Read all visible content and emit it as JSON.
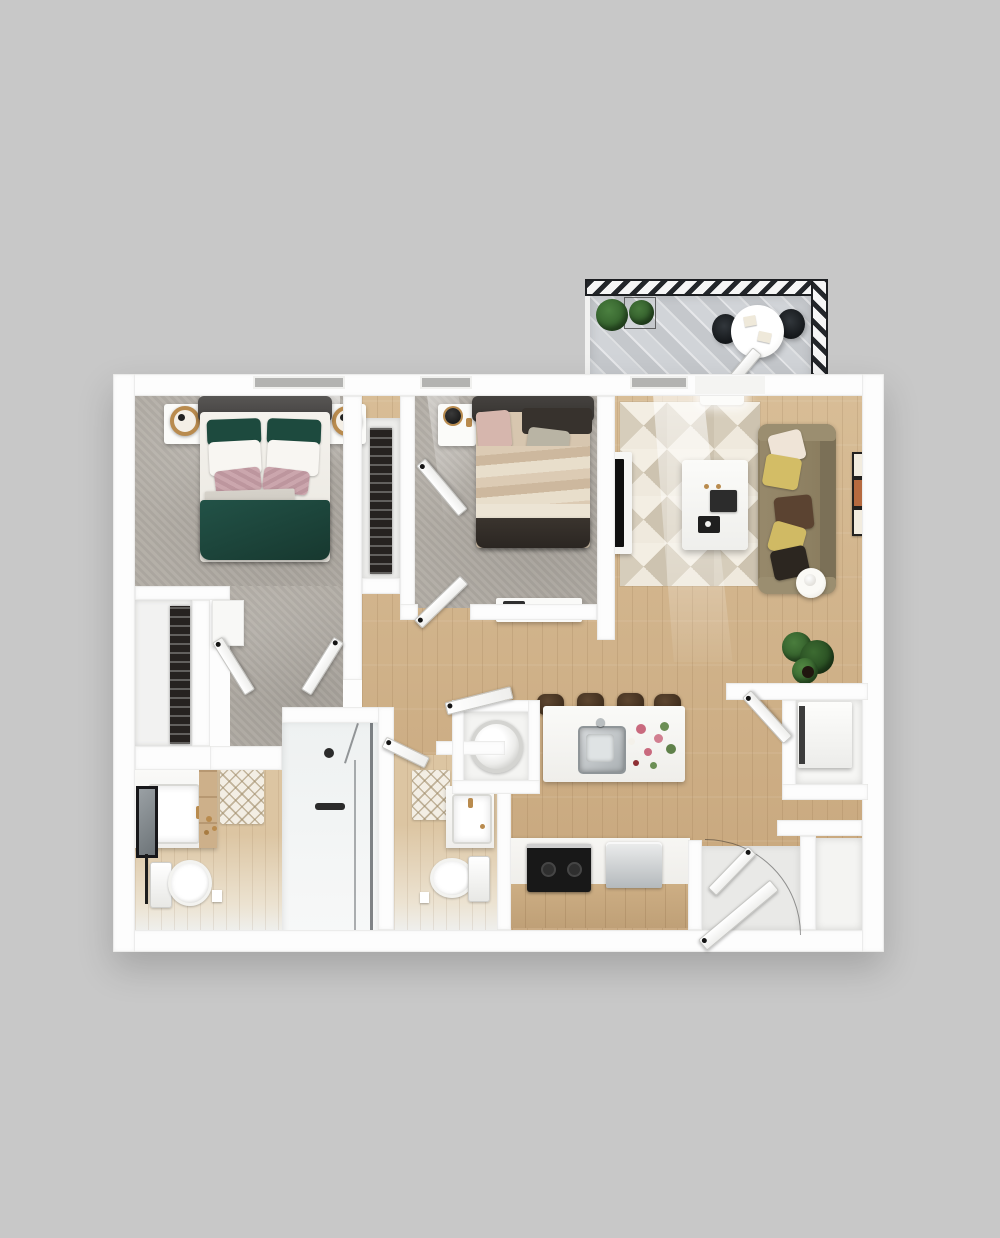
{
  "meta": {
    "scene": "3D top-down rendering of a two-bedroom, two-bath apartment floor plan with balcony",
    "view": "top-down",
    "background_color": "#c8c8c8",
    "visible_text": "none"
  },
  "palette": {
    "background": "#c8c8c8",
    "wall": "#fdfdfd",
    "wall_edge": "#e6e6e4",
    "carpet_gray": "#b2ada5",
    "wood_floor_tan": "#cfae85",
    "bath_floor_light": "#dcc5a2",
    "balcony_floor_gray": "#cdd0d4",
    "railing_black": "#23262a",
    "duvet_green": "#1d473c",
    "pillow_pink": "#c6a1a8",
    "headboard_gray": "#4c4a48",
    "bed2_tan": "#d2bfa5",
    "bed2_footer_brown": "#332d28",
    "sofa_olive": "#8d8063",
    "pillow_yellow": "#d3bd66",
    "pillow_brown": "#5b4331",
    "rug_cream": "#efe9dd",
    "rug_taupe": "#cdc3b0",
    "stool_brown": "#4a3728",
    "stove_black": "#181818",
    "stainless_silver": "#aeb3b6",
    "plant_green": "#3b6c31",
    "brass_gold": "#b98b4e"
  },
  "areas": {
    "balcony": {
      "label": "Balcony",
      "items": [
        "hatched railing",
        "two potted plants",
        "round bistro table",
        "two black chairs",
        "balcony door"
      ]
    },
    "bedroom_1": {
      "label": "Bedroom 1",
      "items": [
        "double bed with green duvet and blush accent pillows",
        "two white nightstands with brass ring lamps",
        "window"
      ]
    },
    "bedroom_1_vestibule": {
      "label": "Bedroom 1 Vestibule",
      "items": [
        "two swing doors"
      ]
    },
    "walk_in_closet": {
      "label": "Walk-in Closet",
      "items": [
        "clothes rack"
      ]
    },
    "linen_closet": {
      "label": "Linen Closet",
      "items": [
        "white cabinet",
        "swing door"
      ]
    },
    "closet_bedroom_2": {
      "label": "Bedroom 2 Closet",
      "items": [
        "clothes rack",
        "swing door"
      ]
    },
    "bedroom_2": {
      "label": "Bedroom 2",
      "items": [
        "double bed with tan striped bedding and dark footer",
        "nightstand with black lamp",
        "white dresser with laptop",
        "two wall pictures",
        "window"
      ]
    },
    "living_room": {
      "label": "Living Room",
      "items": [
        "olive sofa with five pillows",
        "geometric triangle rug",
        "white coffee table with tablet and books",
        "tv on media console",
        "round side table",
        "floor plant",
        "three wall frames",
        "ceiling light"
      ]
    },
    "kitchen": {
      "label": "Kitchen",
      "items": [
        "island with stainless sink and flowers",
        "four bar stools",
        "black range cooktop",
        "stainless dishwasher",
        "wood base cabinets"
      ]
    },
    "hallway": {
      "label": "Hallway",
      "items": [
        "swing doors"
      ]
    },
    "bathroom_1": {
      "label": "Bathroom 1",
      "items": [
        "vanity with sink, leaning mirror and brass faucet",
        "toilet",
        "diamond bath mat",
        "towel bar"
      ]
    },
    "shower": {
      "label": "Walk-in Shower",
      "items": [
        "glass enclosure",
        "dark fixtures"
      ]
    },
    "bathroom_2": {
      "label": "Bathroom 2",
      "items": [
        "vanity with sink",
        "toilet",
        "diamond bath mat"
      ]
    },
    "laundry_closet": {
      "label": "Laundry Closet",
      "items": [
        "front-load washer dryer"
      ]
    },
    "utility_closet": {
      "label": "Utility Closet",
      "items": [
        "water heater unit",
        "swing door"
      ]
    },
    "entry": {
      "label": "Entry",
      "items": [
        "front door with swing arc",
        "entry closet with door"
      ]
    }
  }
}
